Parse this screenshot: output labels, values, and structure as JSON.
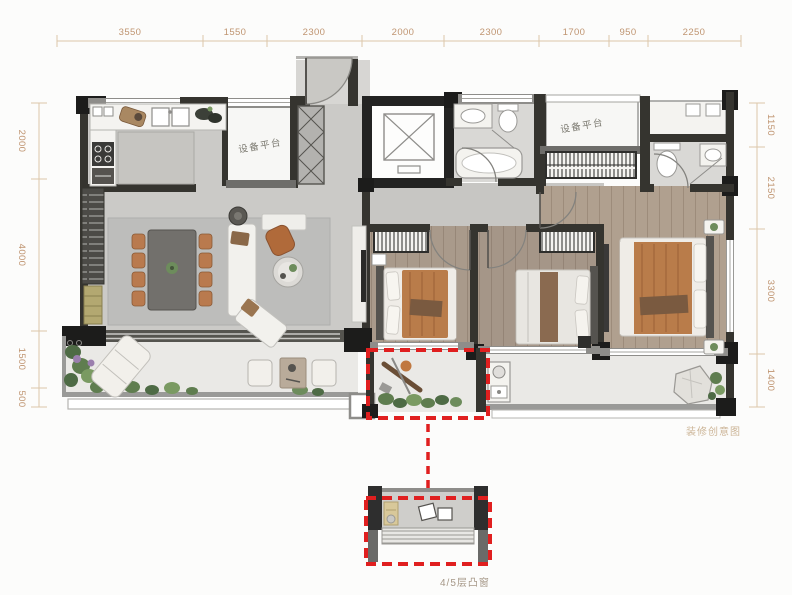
{
  "dimensions": {
    "top": [
      "3550",
      "1550",
      "2300",
      "2000",
      "2300",
      "1700",
      "950",
      "2250"
    ],
    "left": [
      "2000",
      "4000",
      "1500",
      "500"
    ],
    "right": [
      "1150",
      "2150",
      "3300",
      "1400"
    ]
  },
  "labels": {
    "equipment_platform_1": "设备平台",
    "equipment_platform_2": "设备平台",
    "bay_window_note": "4/5层凸窗",
    "watermark": "装修创意图"
  },
  "colors": {
    "dimension_text": "#bf9470",
    "dimension_line": "#dcc6aa",
    "highlight_red": "#e01f1f",
    "wall_dark": "#35342f",
    "wall_black": "#1c1c1b",
    "floor_stone": "#cbcac7",
    "floor_wood": "#a99a8b",
    "floor_balcony": "#eae9e6",
    "accent_orange": "#b97a4e",
    "plant_green": "#5f7d4f"
  }
}
